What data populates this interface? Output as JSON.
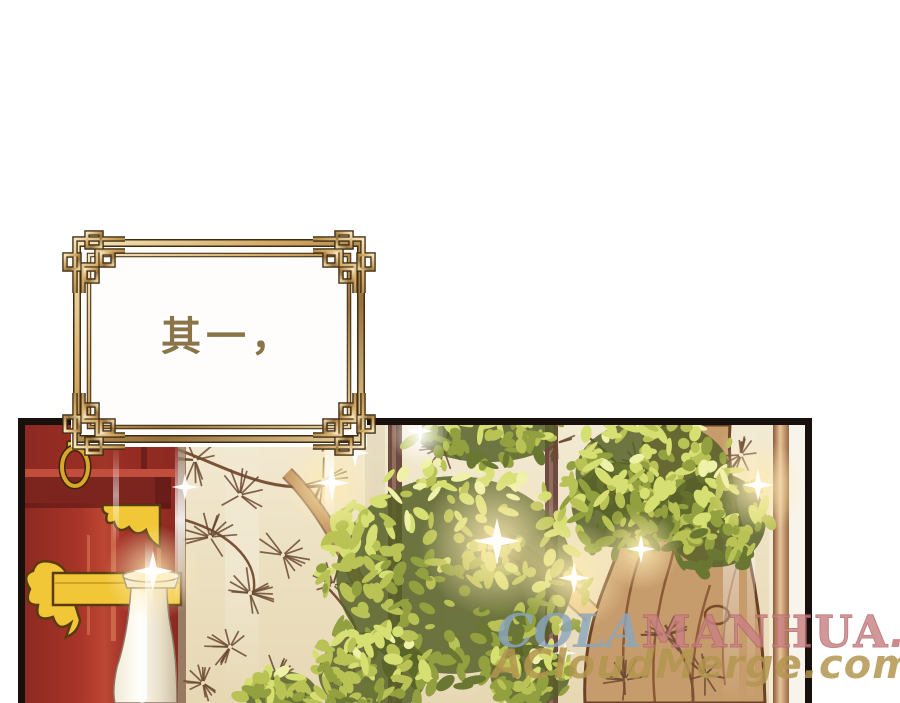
{
  "page": {
    "background_color": "#ffffff"
  },
  "dialog_box": {
    "text": "其一，",
    "text_color": "#8a7448",
    "frame_gold_color": "#cda265",
    "frame_outline_color": "#3f2d14"
  },
  "watermark": {
    "line1": {
      "cola": "COLA",
      "manhua": "MANHUA",
      "dotcom": ".com",
      "cola_color": "#8ba6bd",
      "manhua_color": "#c98082",
      "dotcom_color": "#c3706f"
    },
    "line2": {
      "text": "ACloudMerge.com",
      "color": "#b3964f"
    }
  },
  "scene": {
    "palette": {
      "panel_border": "#17100c",
      "cabinet_red": "#a23129",
      "beam_dark_red": "#7c241e",
      "hardware_gold": "#f1c738",
      "vase_white": "#f4efdf",
      "screen_cream": "#eee3c6",
      "screen_frame_brown": "#6d4b41",
      "pine_ink_brown": "#6b4a33",
      "trunk_tan": "#c59a6b",
      "foliage_green": "#ccd45e"
    }
  }
}
